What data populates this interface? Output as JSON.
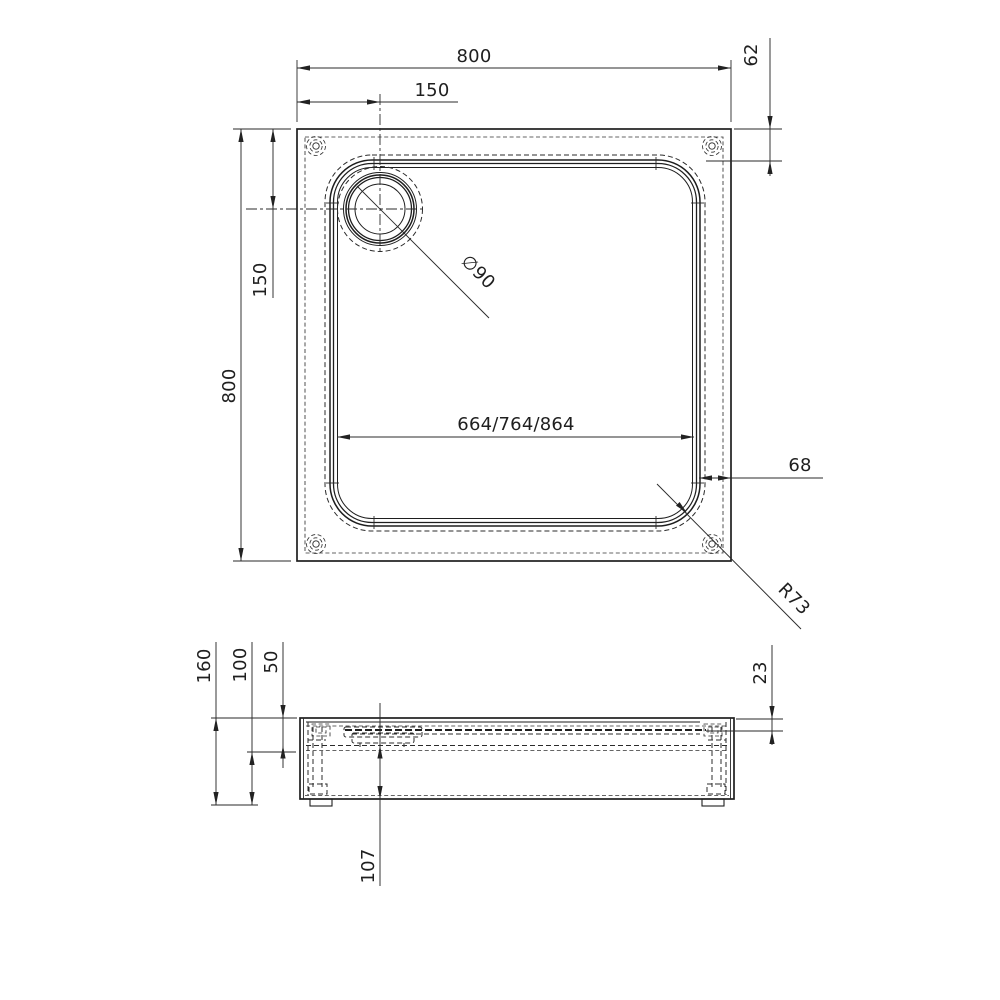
{
  "drawing": {
    "description": "Technical dimension drawing of a square shower tray: plan view and side section view",
    "colors": {
      "line": "#1e1e1e",
      "dimension": "#2b2b2b",
      "background": "#ffffff"
    },
    "top_view": {
      "outer_width_label": "800",
      "outer_height_label": "800",
      "drain_offset_x_label": "150",
      "drain_offset_y_label": "150",
      "rim_clearance_label": "62",
      "inner_width_label": "664/764/864",
      "edge_gap_label": "68",
      "drain_diameter_label": "∅90",
      "corner_radius_label": "R73"
    },
    "side_view": {
      "total_height_label": "160",
      "base_height_label": "100",
      "rim_height_label": "50",
      "basin_depth_label": "23",
      "drain_clearance_label": "107"
    }
  }
}
